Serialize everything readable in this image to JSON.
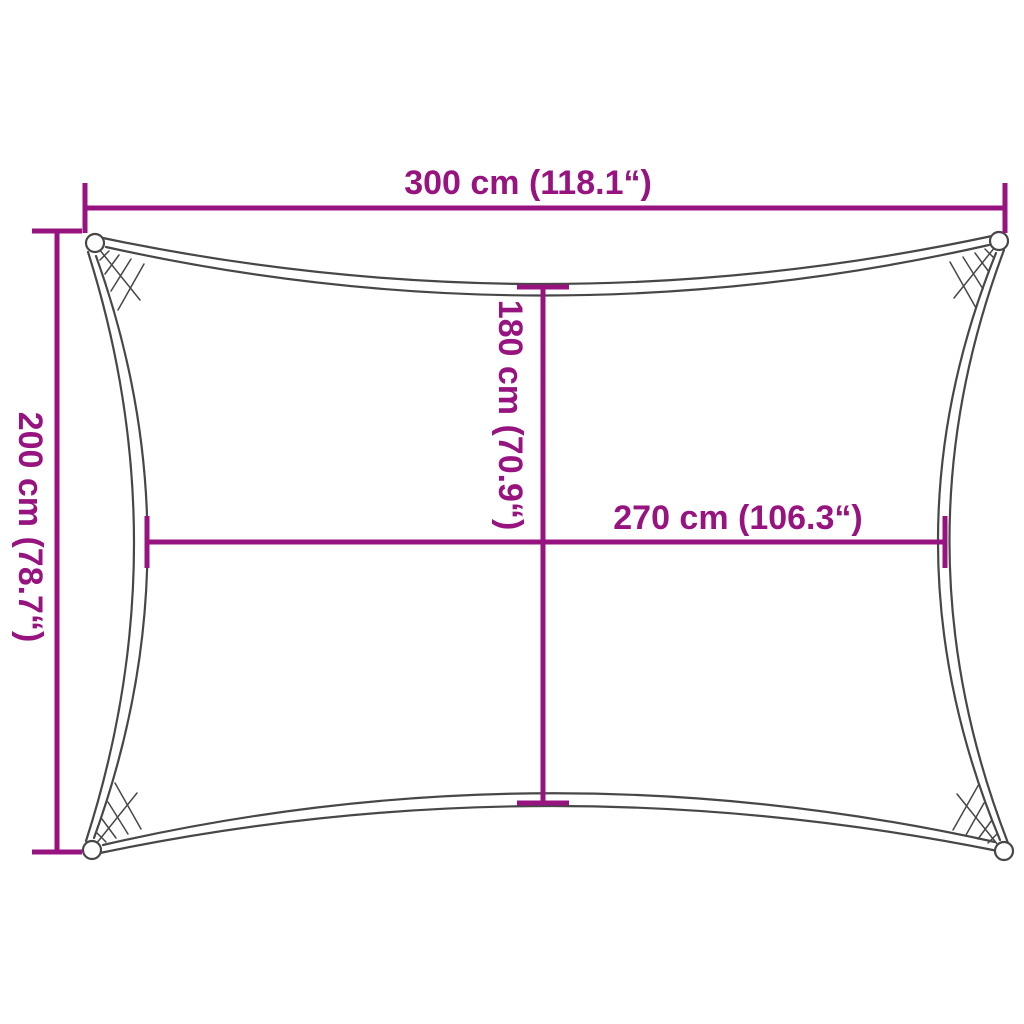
{
  "colors": {
    "dimension": "#97137F",
    "outline": "#474747",
    "background": "#FFFFFF"
  },
  "dimensions": {
    "top": {
      "label": "300 cm (118.1“)",
      "value_cm": 300,
      "value_inch": 118.1
    },
    "left": {
      "label": "200 cm (78.7“)",
      "value_cm": 200,
      "value_inch": 78.7
    },
    "vertical_center": {
      "label": "180 cm (70.9“)",
      "value_cm": 180,
      "value_inch": 70.9
    },
    "horizontal_center": {
      "label": "270 cm (106.3“)",
      "value_cm": 270,
      "value_inch": 106.3
    }
  }
}
